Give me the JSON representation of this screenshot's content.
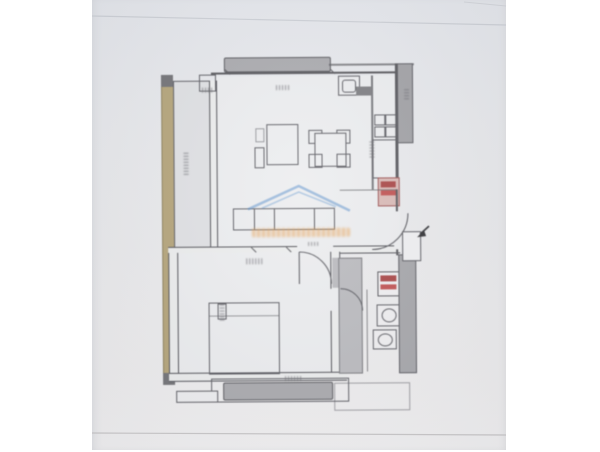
{
  "meta": {
    "content_type": "photographed architectural floor plan",
    "note": "hand-drafted apartment plan on grey paper; all dimension labels are too small to be legible"
  },
  "palette": {
    "page_bg": "#ffffff",
    "paper": "#e9eaec",
    "drawing_line": "#55555a",
    "wall_slab_gray": "#a8a8ac",
    "insulation_tan": "#b3a276",
    "bathroom_floor_gray": "#b9b9bd",
    "appliance_red": "#a84444",
    "appliance_pink": "#d9b9b5",
    "watermark_blue": "#4a86c8",
    "watermark_orange": "#e8a050"
  },
  "watermark": {
    "shape": "house roof outline",
    "text_legibility": "illegible orange wordmark under roof"
  },
  "rooms": [
    {
      "name": "balcony-left"
    },
    {
      "name": "living-room-with-kitchen"
    },
    {
      "name": "hallway-entry"
    },
    {
      "name": "bedroom"
    },
    {
      "name": "bathroom"
    },
    {
      "name": "balcony-bottom"
    }
  ],
  "furniture_fixtures": [
    "top-slab",
    "rug",
    "dining-table-with-4-chairs",
    "tv-unit",
    "kitchen-sink",
    "stove-4-burners",
    "kitchen-counter",
    "fridge",
    "wardrobe",
    "double-bed",
    "nightstand",
    "washing-machine",
    "bathroom-sink",
    "toilet"
  ]
}
